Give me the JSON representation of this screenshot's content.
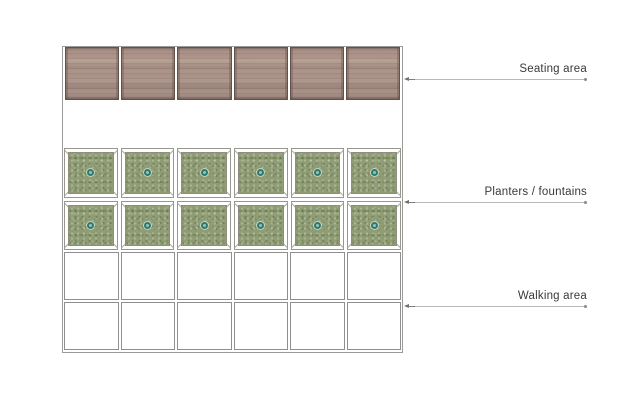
{
  "canvas": {
    "width": 620,
    "height": 413,
    "background": "#ffffff"
  },
  "diagram": {
    "seating": {
      "panel_count": 6,
      "texture": "wood-planks"
    },
    "planters": {
      "rows": 2,
      "cols": 6,
      "icon": "fountain-icon"
    },
    "walking": {
      "rows": 2,
      "cols": 6
    }
  },
  "annotations": {
    "seating": {
      "label": "Seating area"
    },
    "planters": {
      "label": "Planters / fountains"
    },
    "walking": {
      "label": "Walking area"
    }
  },
  "colors": {
    "outline": "#9a9a9a",
    "wood_base": "#ab9186",
    "wood_edge": "#63524b",
    "planter_frame_line": "#97978d",
    "planter_green": "#8f9c74",
    "fountain_ring": "#2d7a71",
    "fountain_center": "#9cc0b7",
    "walking_line": "#8f8f8f",
    "leader_line": "#b9b9b9",
    "label_text": "#3a3a3a"
  }
}
